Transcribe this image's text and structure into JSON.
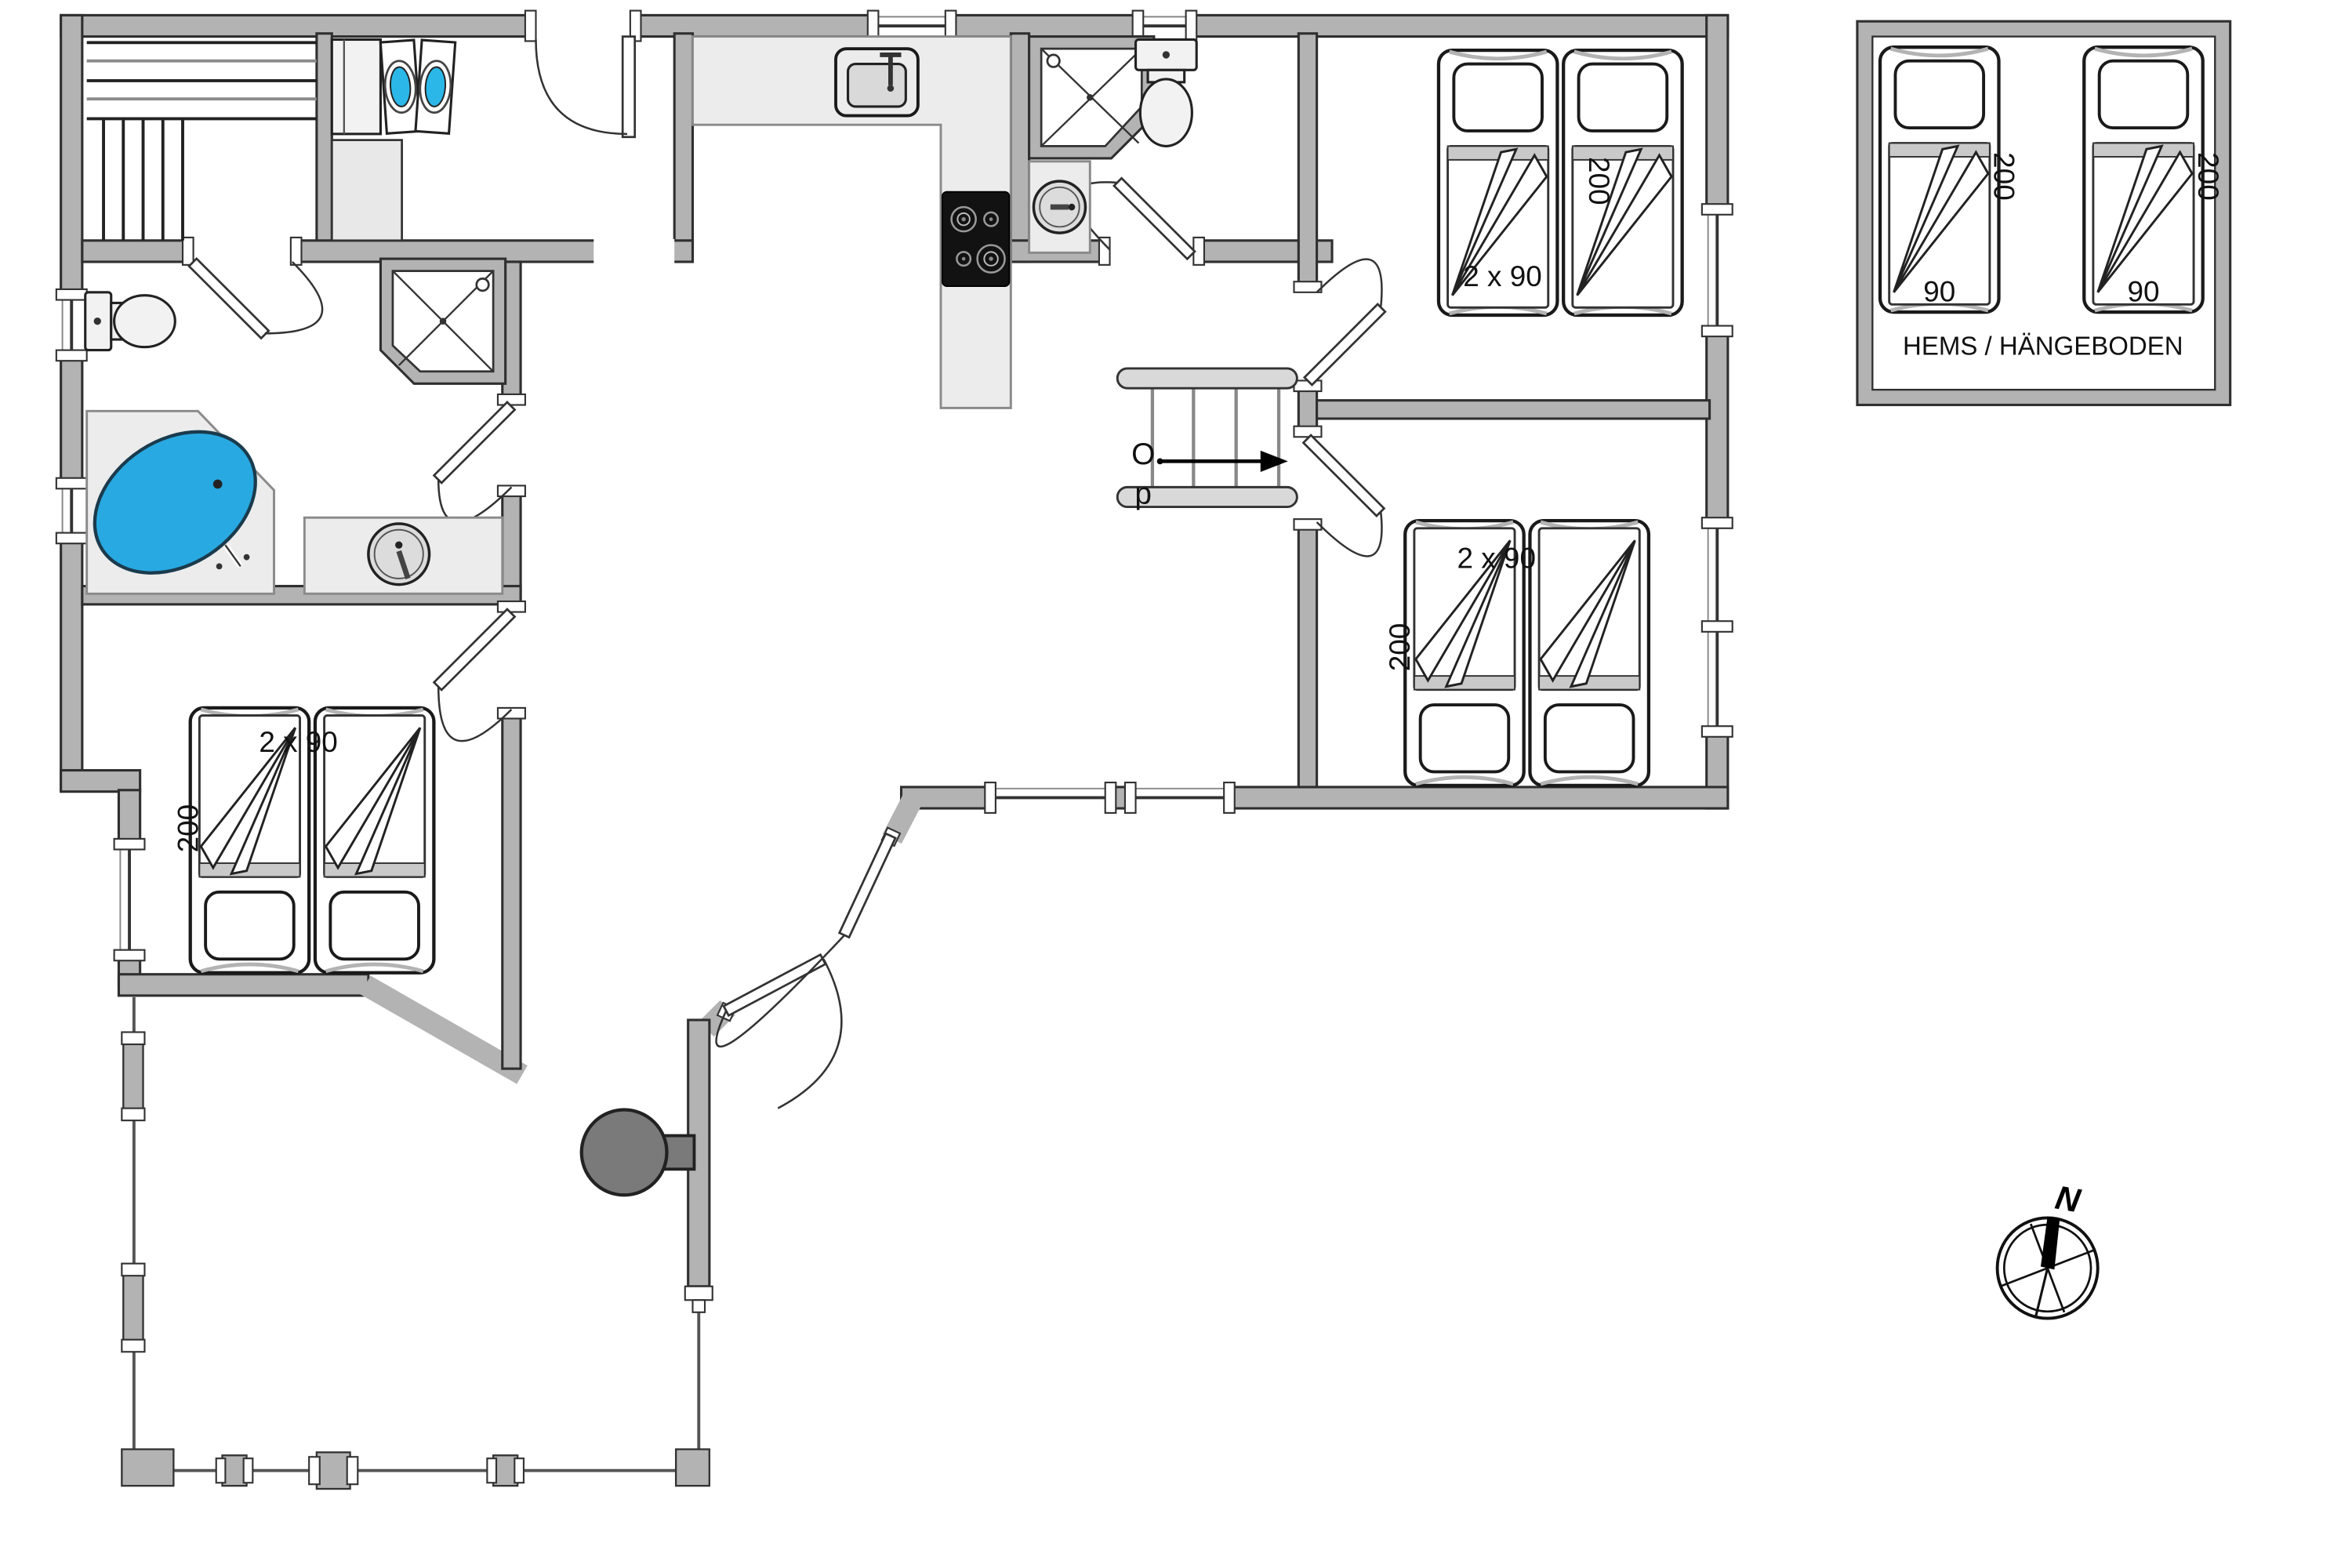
{
  "rooms": {
    "bedroom_1": {
      "bed_size": "2 x 90",
      "bed_length": "200"
    },
    "bedroom_2": {
      "bed_size": "2 x 90",
      "bed_length": "200"
    },
    "bedroom_3": {
      "bed_size": "2 x 90",
      "bed_length": "200"
    },
    "loft": {
      "caption": "HEMS / HÄNGEBODEN",
      "beds": [
        {
          "length": "200",
          "width": "90"
        },
        {
          "length": "200",
          "width": "90"
        }
      ]
    }
  },
  "stairs": {
    "direction_label": "Op",
    "line1": "O",
    "line2": "p"
  },
  "compass": {
    "north": "N"
  },
  "colors": {
    "wall": "#b3b3b3",
    "tub": "#29a9e1",
    "washer_door": "#2bb7e8",
    "grill": "#7a7a7a",
    "cooktop": "#121212"
  }
}
